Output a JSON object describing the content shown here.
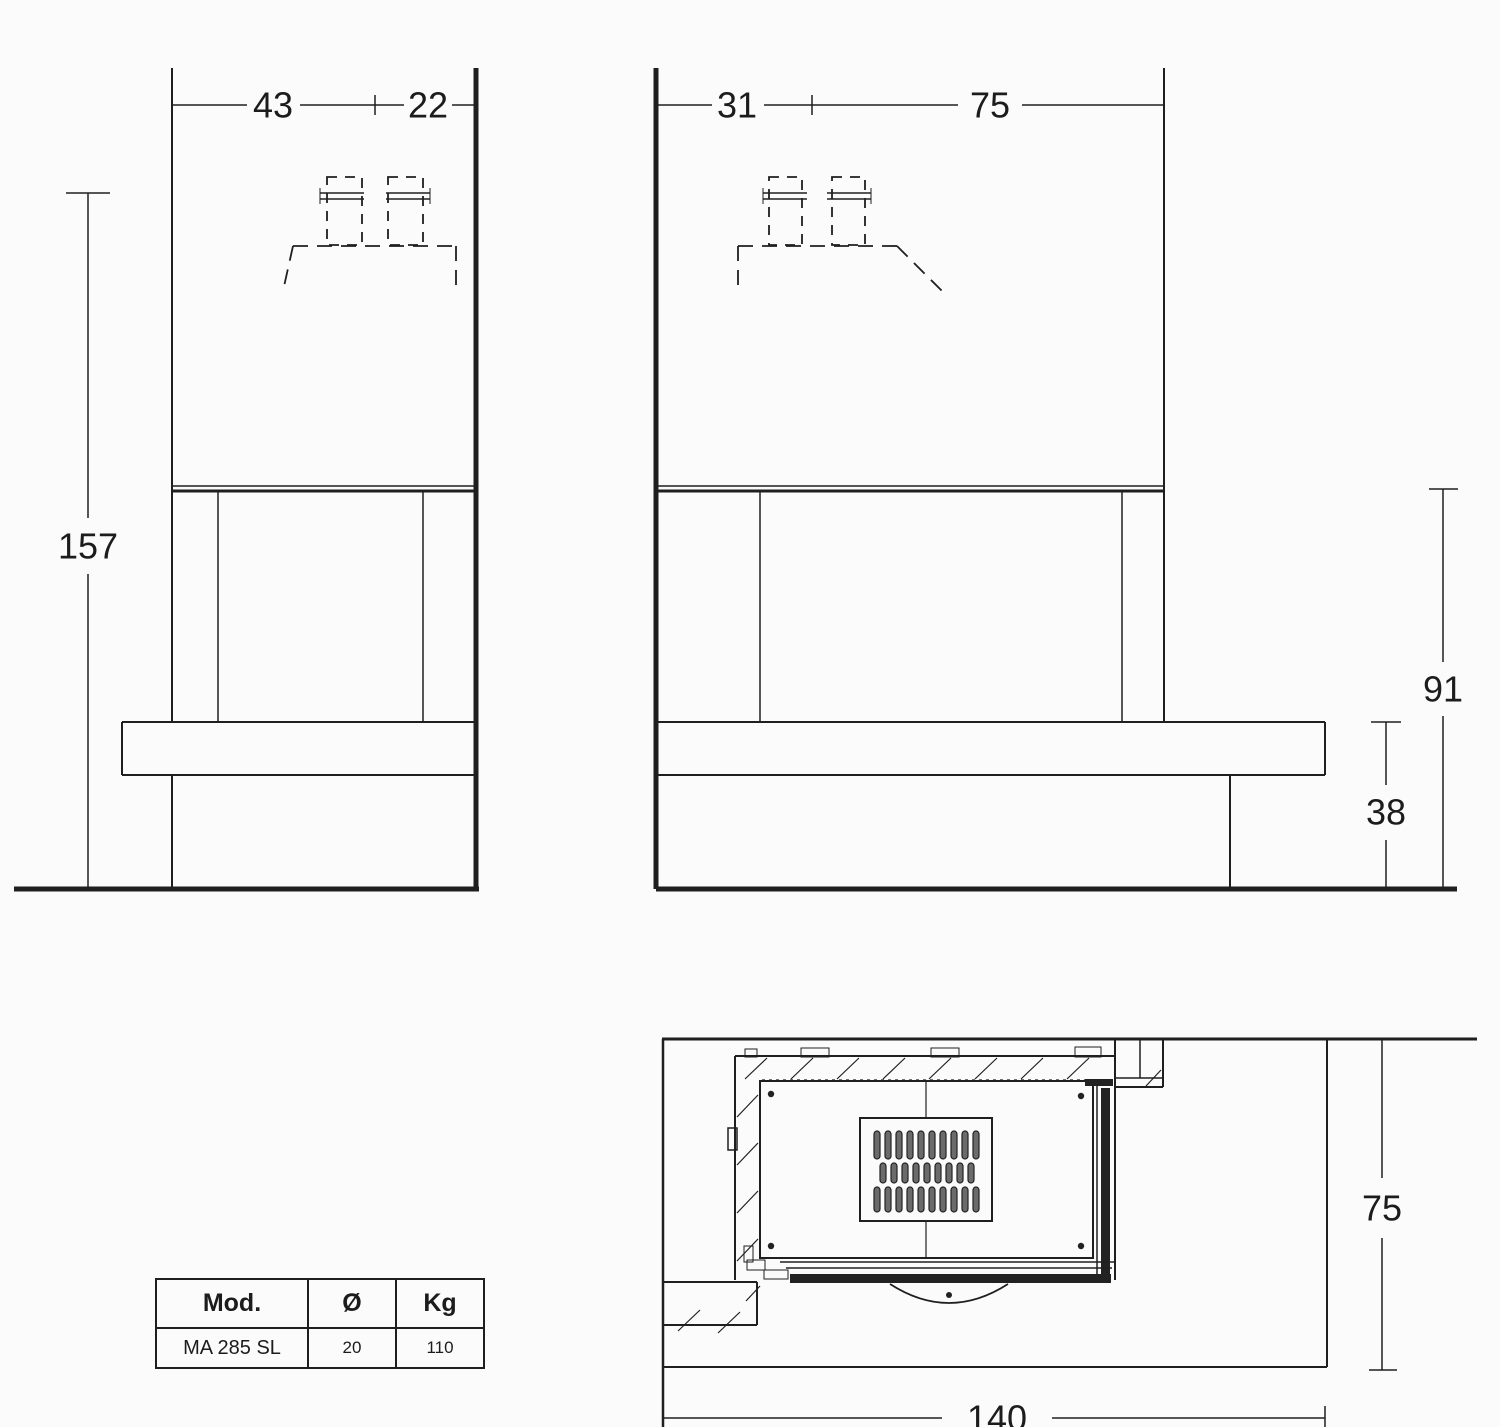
{
  "front_view": {
    "width_left": "43",
    "width_right": "22",
    "height_total": "157"
  },
  "side_view": {
    "depth_front": "31",
    "depth_rear": "75",
    "height_opening": "91",
    "height_hearth": "38"
  },
  "plan_view": {
    "depth": "75",
    "width": "140"
  },
  "spec_table": {
    "header": {
      "model": "Mod.",
      "diameter": "Ø",
      "weight": "Kg"
    },
    "row": {
      "model": "MA 285 SL",
      "diameter": "20",
      "weight": "110"
    }
  }
}
